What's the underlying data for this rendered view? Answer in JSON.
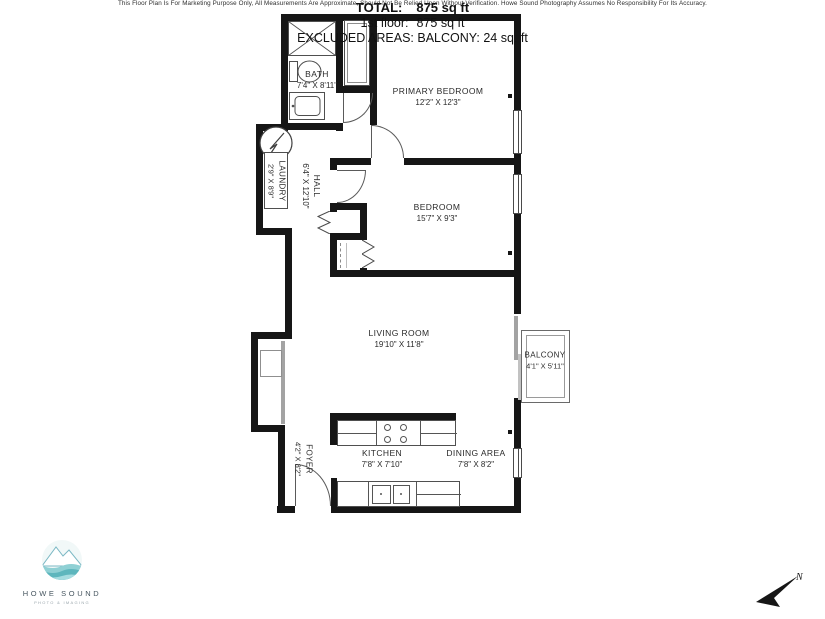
{
  "plan": {
    "rooms": [
      {
        "name": "BATH",
        "dims": "7'4\" X 8'11\""
      },
      {
        "name": "PRIMARY BEDROOM",
        "dims": "12'2\" X 12'3\""
      },
      {
        "name": "LAUNDRY",
        "dims": "2'9\" X 8'9\""
      },
      {
        "name": "HALL",
        "dims": "6'4\" X 12'10\""
      },
      {
        "name": "BEDROOM",
        "dims": "15'7\" X 9'3\""
      },
      {
        "name": "LIVING ROOM",
        "dims": "19'10\" X 11'8\""
      },
      {
        "name": "BALCONY",
        "dims": "4'1\" X 5'11\""
      },
      {
        "name": "KITCHEN",
        "dims": "7'8\" X 7'10\""
      },
      {
        "name": "DINING AREA",
        "dims": "7'8\" X 8'2\""
      },
      {
        "name": "FOYER",
        "dims": "4'2\" X 8'2\""
      }
    ],
    "summary": {
      "total_label": "TOTAL:",
      "total_value": "875 sq ft",
      "floor_label": "1st floor:",
      "floor_value": "875 sq ft",
      "excluded": "EXCLUDED AREAS: BALCONY: 24 sq. ft"
    },
    "disclaimer": "This Floor Plan Is For Marketing Purpose Only, All Measurements Are Approximate, Should Not Be Relied Upon Without Verification. Howe Sound Photography Assumes No Responsibility For Its Accuracy.",
    "logo": {
      "line1": "HOWE SOUND",
      "line2": "PHOTO & IMAGING"
    },
    "compass": {
      "label": "N"
    },
    "colors": {
      "wall": "#161616",
      "teal_light": "#a5dce0",
      "teal_mid": "#8fd0d4",
      "teal_dark": "#5db6bd"
    }
  }
}
